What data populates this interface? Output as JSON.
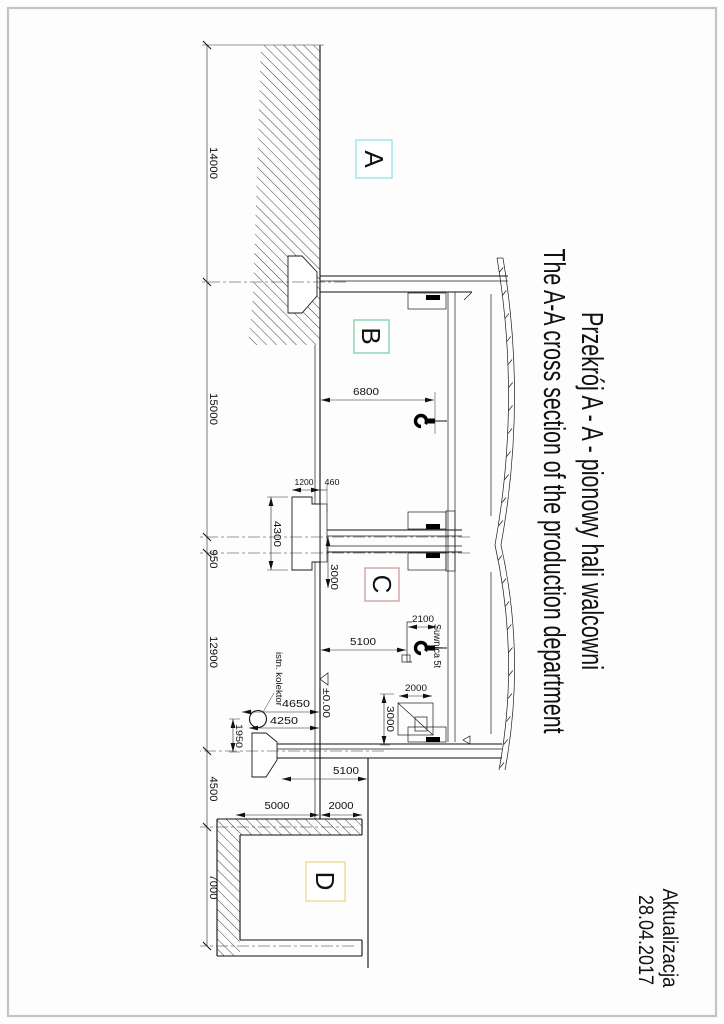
{
  "title": {
    "polish": "Przekrój A - A - pionowy hali walcowni",
    "english": "The A-A cross section of the production department"
  },
  "revision": {
    "label": "Aktualizacja",
    "date": "28.04.2017"
  },
  "zones": [
    {
      "id": "A",
      "color": "#22d1d1",
      "box_color": "#8fe3e3"
    },
    {
      "id": "B",
      "color": "#00a651",
      "box_color": "#7fcfa8"
    },
    {
      "id": "C",
      "color": "#e0211a",
      "box_color": "#cf9c9c"
    },
    {
      "id": "D",
      "color": "#e3cd3f",
      "box_color": "#ead88f"
    }
  ],
  "axis_chain": [
    "14000",
    "15000",
    "950",
    "12900",
    "4500",
    "7000"
  ],
  "heights": {
    "hook_clearance_b": "6800",
    "hook_clearance_c": "5100",
    "crane_trolley": "2100",
    "outer_foundation": "5100"
  },
  "level_mark": "±0.00",
  "crane_label": "Suwnica 5t",
  "collector": {
    "label": "istn. kolektor",
    "depth_top": "4650",
    "depth_bottom": "4250",
    "width": "1950"
  },
  "foundation": {
    "plinth_height": "460",
    "footing_depth": "1200",
    "footing_width": "4300",
    "axis_offset": "3000"
  },
  "wall_unit": {
    "width": "3000",
    "height": "2000"
  },
  "pit": {
    "above_floor": "2000",
    "below_floor": "5000"
  }
}
